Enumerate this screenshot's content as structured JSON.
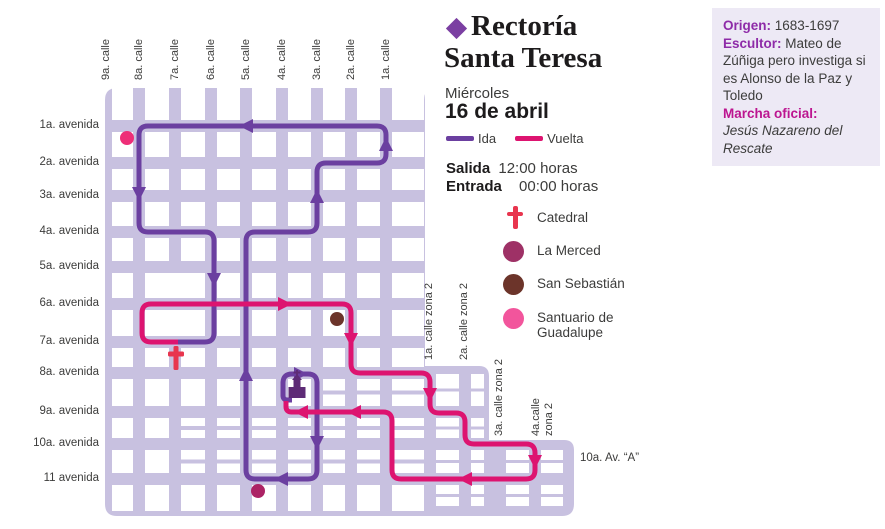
{
  "header": {
    "title_line1": "Rectoría",
    "title_line2": "Santa Teresa",
    "diamond_color": "#7B3FA2",
    "day": "Miércoles",
    "date": "16 de abril",
    "ida_label": "Ida",
    "vuelta_label": "Vuelta",
    "salida_label": "Salida",
    "salida_value": "12:00 horas",
    "entrada_label": "Entrada",
    "entrada_value": "00:00 horas"
  },
  "sidebar": {
    "background": "#EDE9F5",
    "label_color": "#8E2BA8",
    "marcha_color": "#BC1590",
    "origen_label": "Origen:",
    "origen_value": "1683-1697",
    "escultor_label": "Escultor:",
    "escultor_value": "Mateo de Zúñiga pero investiga si es Alonso de la Paz y Toledo",
    "marcha_label": "Marcha oficial:",
    "marcha_value": "Jesús Nazareno del Rescate"
  },
  "legend": {
    "items": [
      {
        "name": "Catedral",
        "type": "cross",
        "color": "#E8354E"
      },
      {
        "name": "La Merced",
        "type": "dot",
        "color": "#9E3166"
      },
      {
        "name": "San Sebastián",
        "type": "dot",
        "color": "#6C342A"
      },
      {
        "name": "Santuario de Guadalupe",
        "type": "dot",
        "color": "#F2559C"
      }
    ]
  },
  "map": {
    "base_color": "#C8C1E0",
    "block_color": "#FFFFFF",
    "bounds": {
      "x0": 105,
      "y0": 88,
      "x1": 425,
      "y1": 516,
      "ext1_x": 489,
      "ext1_y": 366,
      "ext2_x": 574,
      "ext2_y": 440,
      "radius": 12
    },
    "calles": [
      {
        "label": "9a. calle",
        "x": 106
      },
      {
        "label": "8a. calle",
        "x": 139
      },
      {
        "label": "7a. calle",
        "x": 175
      },
      {
        "label": "6a. calle",
        "x": 211
      },
      {
        "label": "5a. calle",
        "x": 246
      },
      {
        "label": "4a. calle",
        "x": 282
      },
      {
        "label": "3a. calle",
        "x": 317
      },
      {
        "label": "2a. calle",
        "x": 351
      },
      {
        "label": "1a. calle",
        "x": 386
      }
    ],
    "avenidas": [
      {
        "label": "1a. avenida",
        "y": 126
      },
      {
        "label": "2a. avenida",
        "y": 163
      },
      {
        "label": "3a. avenida",
        "y": 196
      },
      {
        "label": "4a. avenida",
        "y": 232
      },
      {
        "label": "5a. avenida",
        "y": 267
      },
      {
        "label": "6a. avenida",
        "y": 304
      },
      {
        "label": "7a. avenida",
        "y": 342
      },
      {
        "label": "8a. avenida",
        "y": 373
      },
      {
        "label": "9a. avenida",
        "y": 412
      },
      {
        "label": "10a. avenida",
        "y": 444
      },
      {
        "label": "11 avenida",
        "y": 479
      }
    ],
    "zona2_calles": [
      {
        "label": "1a. calle zona 2",
        "x": 430,
        "label_bottom_y": 360
      },
      {
        "label": "2a. calle zona 2",
        "x": 465,
        "label_bottom_y": 360
      },
      {
        "label": "3a. calle zona 2",
        "x": 500,
        "label_bottom_y": 436
      },
      {
        "label": "4a.calle\nzona 2",
        "x": 537,
        "label_bottom_y": 436
      }
    ],
    "av_a_label": {
      "label": "10a. Av. “A”",
      "x": 580,
      "y": 452
    },
    "routes": {
      "ida": {
        "name": "Ida",
        "color": "#6B3FA0",
        "width": 5,
        "points": [
          [
            292,
            400
          ],
          [
            283,
            400
          ],
          [
            283,
            374
          ],
          [
            317,
            374
          ],
          [
            317,
            479
          ],
          [
            246,
            479
          ],
          [
            246,
            232
          ],
          [
            317,
            232
          ],
          [
            317,
            163
          ],
          [
            386,
            163
          ],
          [
            386,
            126
          ],
          [
            139,
            126
          ],
          [
            139,
            232
          ],
          [
            214,
            232
          ],
          [
            214,
            342
          ],
          [
            178,
            342
          ]
        ],
        "arrows": [
          [
            299,
            374,
            "right"
          ],
          [
            317,
            441,
            "down"
          ],
          [
            283,
            479,
            "left"
          ],
          [
            246,
            376,
            "up"
          ],
          [
            317,
            198,
            "up"
          ],
          [
            386,
            146,
            "up"
          ],
          [
            248,
            126,
            "left"
          ],
          [
            139,
            192,
            "down"
          ],
          [
            214,
            278,
            "down"
          ]
        ]
      },
      "vuelta": {
        "name": "Vuelta",
        "color": "#DD1470",
        "width": 5,
        "points": [
          [
            178,
            342
          ],
          [
            142,
            342
          ],
          [
            142,
            304
          ],
          [
            351,
            304
          ],
          [
            351,
            373
          ],
          [
            430,
            373
          ],
          [
            430,
            413
          ],
          [
            465,
            413
          ],
          [
            465,
            444
          ],
          [
            535,
            444
          ],
          [
            535,
            479
          ],
          [
            392,
            479
          ],
          [
            392,
            412
          ],
          [
            286,
            412
          ],
          [
            286,
            401
          ]
        ],
        "arrows": [
          [
            283,
            304,
            "right"
          ],
          [
            351,
            338,
            "down"
          ],
          [
            430,
            393,
            "down"
          ],
          [
            535,
            460,
            "down"
          ],
          [
            467,
            479,
            "left"
          ],
          [
            356,
            412,
            "left"
          ],
          [
            303,
            412,
            "left"
          ]
        ]
      }
    },
    "landmarks": [
      {
        "name": "Rectoría Santa Teresa",
        "type": "church",
        "x": 297,
        "y": 391,
        "color": "#5E2B76"
      },
      {
        "name": "Catedral",
        "type": "cross",
        "x": 176,
        "y": 358,
        "color": "#E8354E"
      },
      {
        "name": "La Merced",
        "type": "dot",
        "x": 258,
        "y": 491,
        "color": "#AC2365"
      },
      {
        "name": "San Sebastián",
        "type": "dot",
        "x": 337,
        "y": 319,
        "color": "#6C342A"
      },
      {
        "name": "Santuario de Guadalupe",
        "type": "dot",
        "x": 127,
        "y": 138,
        "color": "#EE2E78"
      }
    ]
  }
}
